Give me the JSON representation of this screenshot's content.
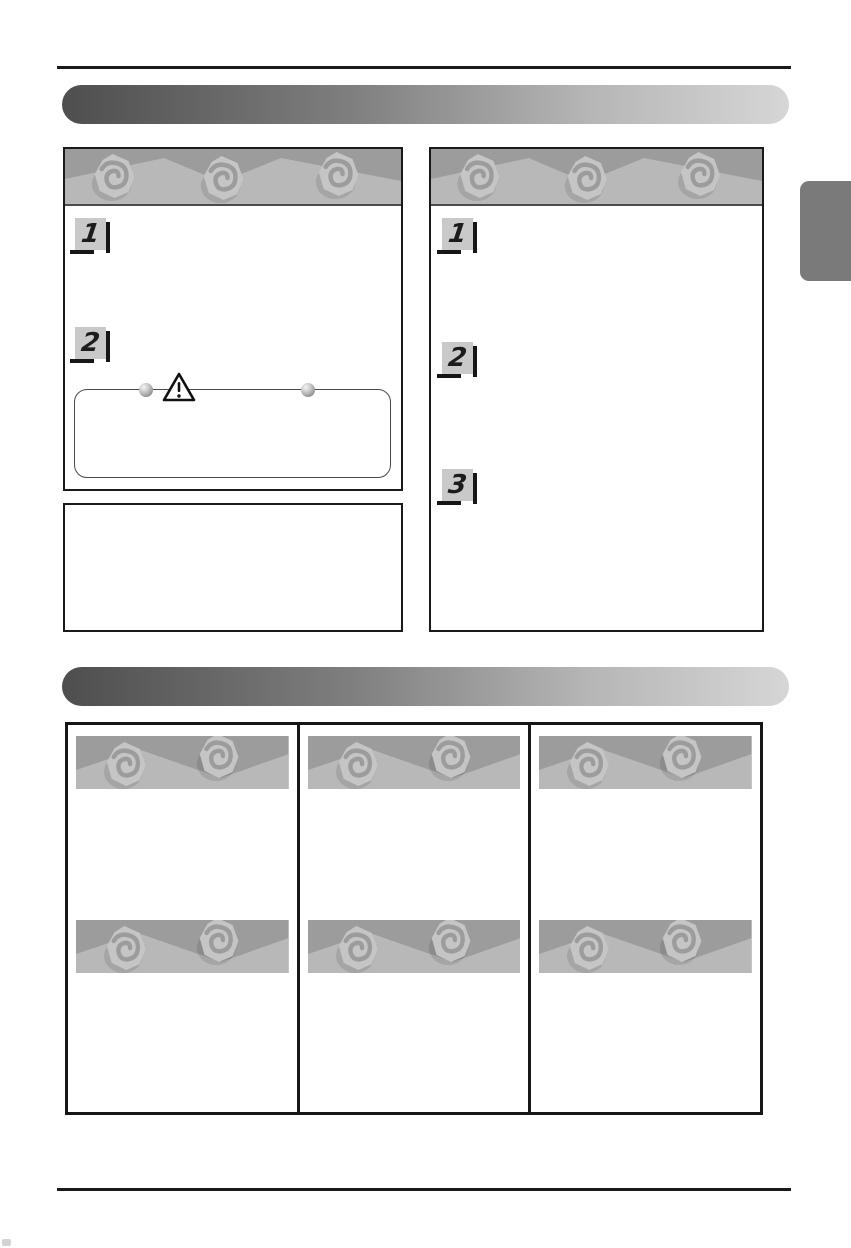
{
  "document": {
    "kind": "manual-page-scan",
    "legible_text_present": false
  },
  "colors": {
    "rule": "#1a1a1a",
    "banner_gradient_start": "#4e4e4e",
    "banner_gradient_end": "#d6d6d6",
    "band_dark": "#9c9c9c",
    "band_light": "#b8b8b8",
    "swirl_blob": "#c5c5c5",
    "swirl_line": "#9c9c9c",
    "badge_background": "#c9c9c9",
    "badge_shadow": "#161616",
    "side_tab": "#7a7a7a",
    "box_border": "#1a1a1a"
  },
  "icons": {
    "swirl": "spiral-rosette-ornament",
    "band": "zigzag-mountain-pattern",
    "warning": "warning-triangle",
    "pin": "sphere-pin"
  },
  "top_section": {
    "left_panel": {
      "steps": [
        {
          "number": "1"
        },
        {
          "number": "2"
        }
      ],
      "caution_note": {
        "bullet_pins": 2
      }
    },
    "right_panel": {
      "steps": [
        {
          "number": "1"
        },
        {
          "number": "2"
        },
        {
          "number": "3"
        }
      ]
    }
  },
  "bottom_section": {
    "grid": {
      "columns": 3,
      "rows": 2
    }
  }
}
